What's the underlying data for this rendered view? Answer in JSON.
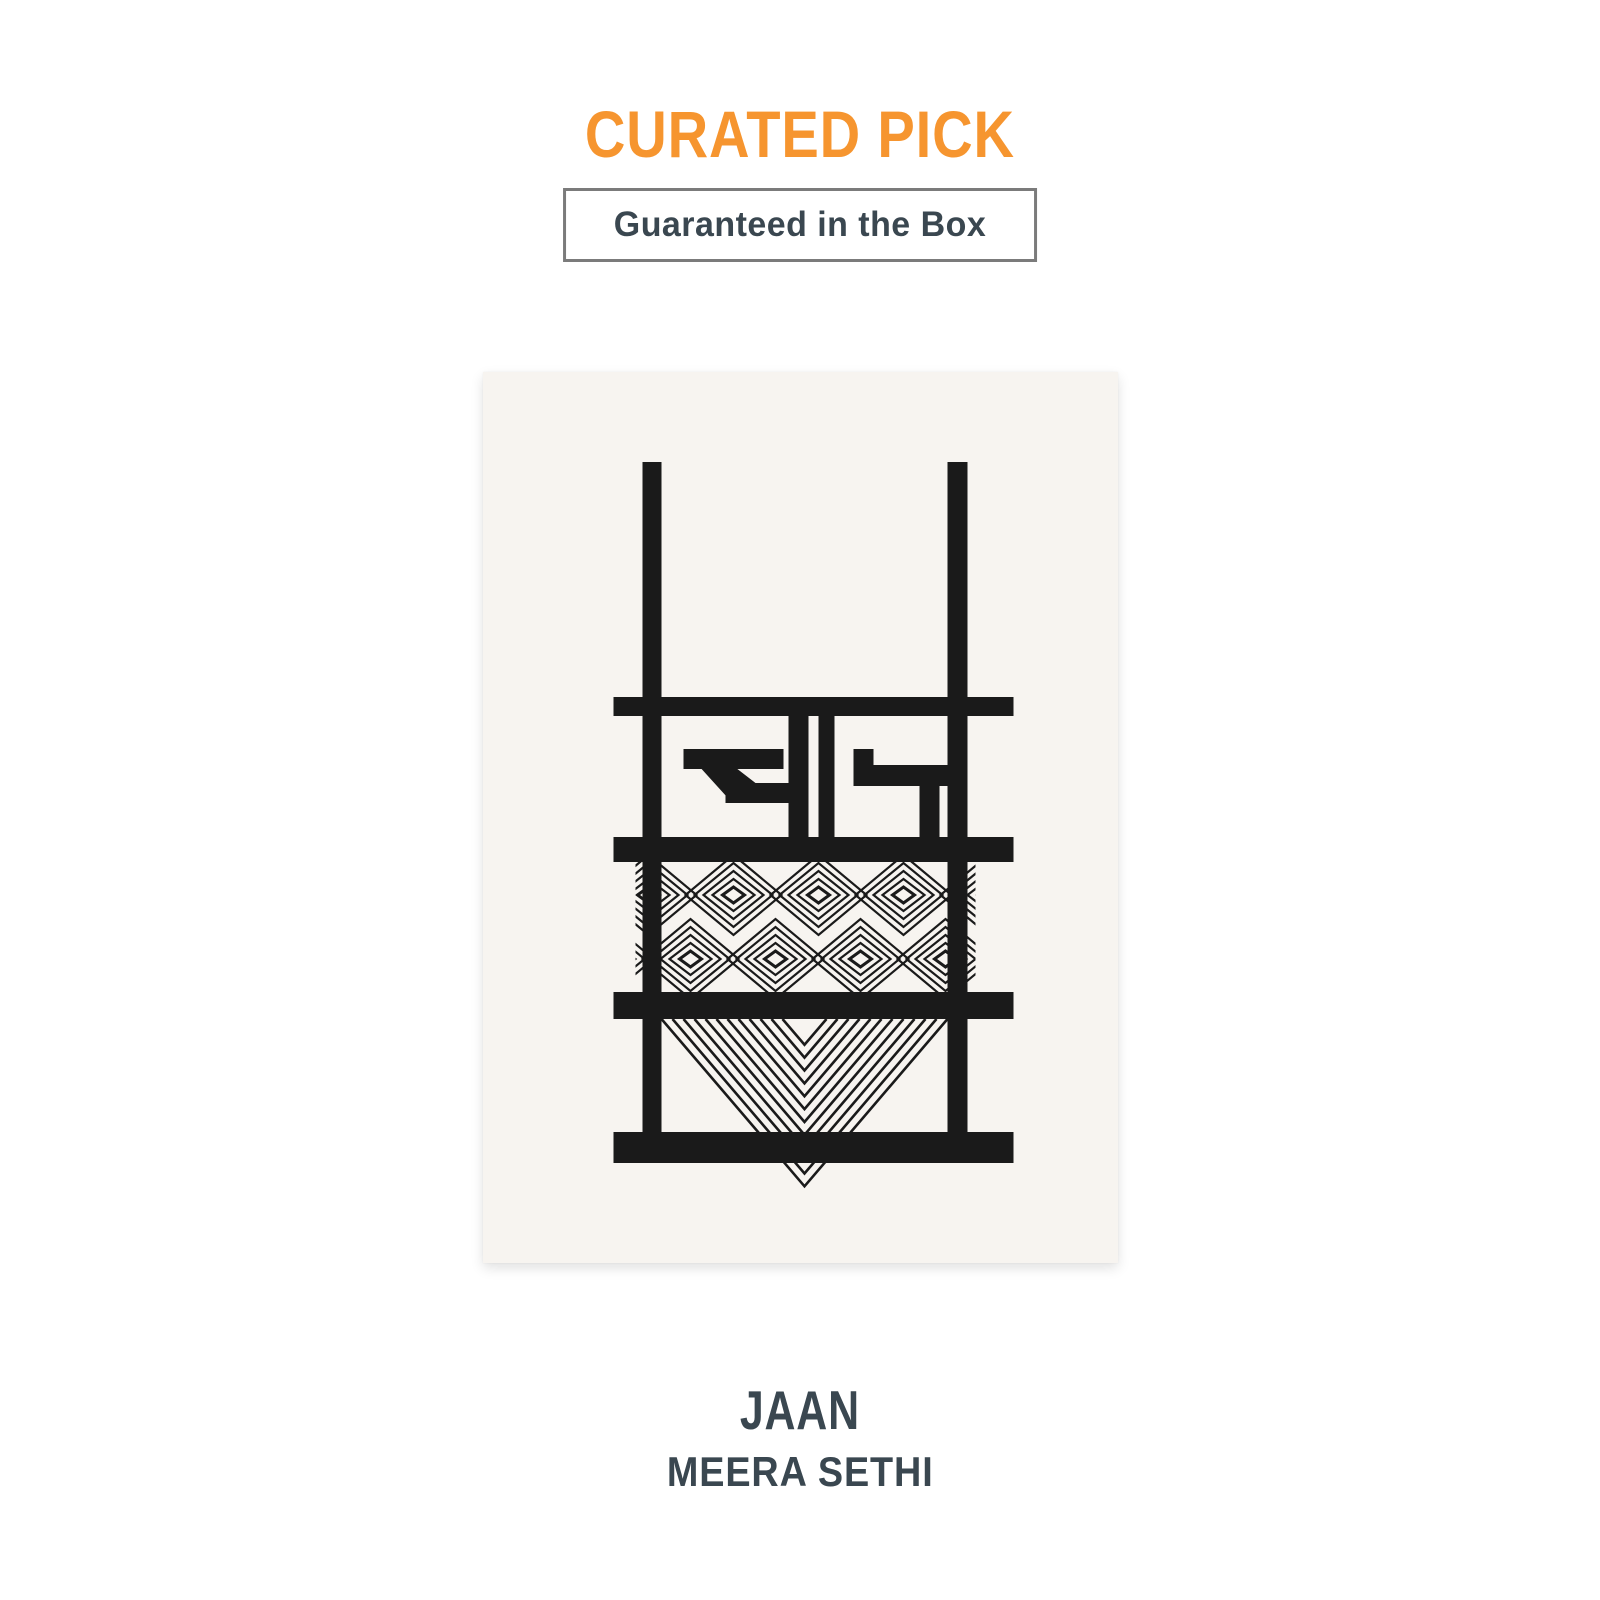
{
  "page": {
    "background": "#FFFFFF"
  },
  "header": {
    "eyebrow": "CURATED PICK",
    "eyebrow_color": "#F6952F",
    "badge_label": "Guaranteed in the Box",
    "badge_text_color": "#3A4750",
    "badge_border_color": "#7B7B7B"
  },
  "artwork": {
    "card_bg": "#F7F4F0",
    "ink_color": "#1A1A1A",
    "devanagari_word": "जान",
    "aria_label": "Black line illustration of a loom frame with the Devanagari word जान, a band of interlocking diamonds and nested chevrons"
  },
  "book": {
    "title": "JAAN",
    "author": "MEERA SETHI",
    "text_color": "#3A4750"
  }
}
